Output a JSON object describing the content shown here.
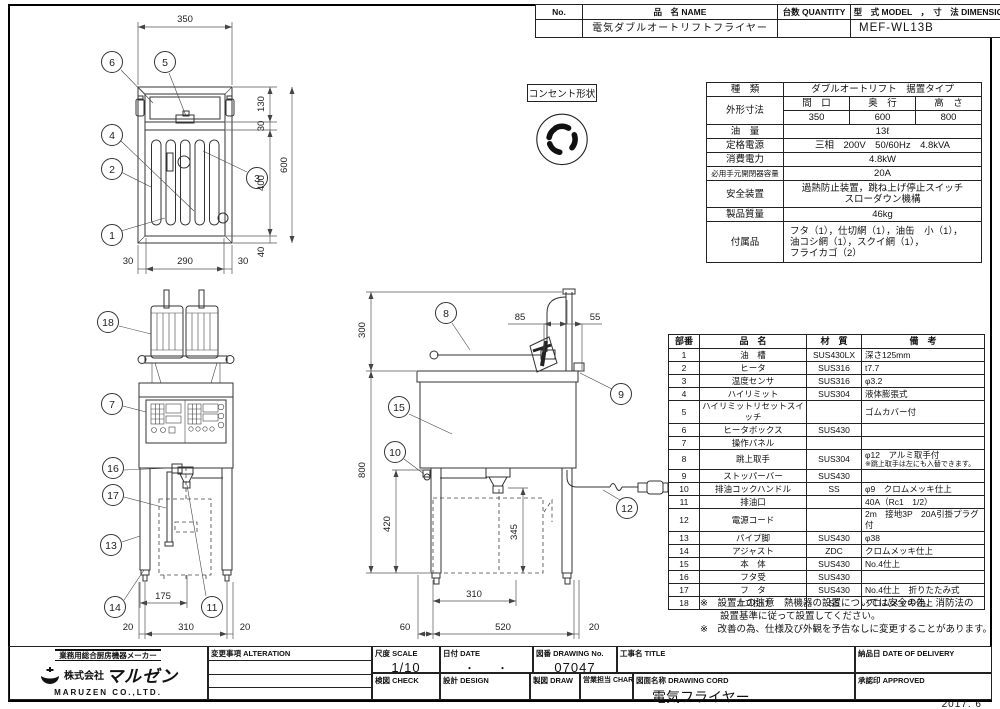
{
  "title_table": {
    "no_label": "No.",
    "name_label": "品　名 NAME",
    "qty_label": "台数 QUANTITY",
    "model_label": "型　式 MODEL　，　寸　法 DIMENSION",
    "name_value": "電気ダブルオートリフトフライヤー",
    "qty_value": "",
    "model_value": "MEF-WL13B"
  },
  "outlet_box": {
    "label": "コンセント形状"
  },
  "spec_table": {
    "kind_label": "種　類",
    "kind_value": "ダブルオートリフト　据置タイプ",
    "dims_label": "外形寸法",
    "width_label": "間　口",
    "depth_label": "奥　行",
    "height_label": "高　さ",
    "width_value": "350",
    "depth_value": "600",
    "height_value": "800",
    "oil_label": "油　量",
    "oil_value": "13ℓ",
    "power_label": "定格電源",
    "power_value": "三相　200V　50/60Hz　4.8kVA",
    "consumption_label": "消費電力",
    "consumption_value": "4.8kW",
    "breaker_label": "必用手元開閉器容量",
    "breaker_value": "20A",
    "safety_label": "安全装置",
    "safety_line1": "過熱防止装置，跳ね上げ停止スイッチ",
    "safety_line2": "スローダウン機構",
    "weight_label": "製品質量",
    "weight_value": "46kg",
    "accessories_label": "付属品",
    "accessories_line1": "フタ（1），仕切網（1），油缶　小（1），",
    "accessories_line2": "油コシ網（1），スクイ網（1），",
    "accessories_line3": "フライカゴ（2）"
  },
  "parts_table": {
    "no_header": "部番",
    "name_header": "品　名",
    "material_header": "材　質",
    "remarks_header": "備　考",
    "rows": [
      {
        "no": "1",
        "name": "油　槽",
        "material": "SUS430LX",
        "remarks": "深さ125mm",
        "remarks2": ""
      },
      {
        "no": "2",
        "name": "ヒータ",
        "material": "SUS316",
        "remarks": "t7.7",
        "remarks2": ""
      },
      {
        "no": "3",
        "name": "温度センサ",
        "material": "SUS316",
        "remarks": "φ3.2",
        "remarks2": ""
      },
      {
        "no": "4",
        "name": "ハイリミット",
        "material": "SUS304",
        "remarks": "液体膨張式",
        "remarks2": ""
      },
      {
        "no": "5",
        "name": "ハイリミットリセットスイッチ",
        "material": "",
        "remarks": "ゴムカバー付",
        "remarks2": ""
      },
      {
        "no": "6",
        "name": "ヒータボックス",
        "material": "SUS430",
        "remarks": "",
        "remarks2": ""
      },
      {
        "no": "7",
        "name": "操作パネル",
        "material": "",
        "remarks": "",
        "remarks2": ""
      },
      {
        "no": "8",
        "name": "跳上取手",
        "material": "SUS304",
        "remarks": "φ12　アルミ取手付",
        "remarks2": "※跳上取手は左にも入替できます。"
      },
      {
        "no": "9",
        "name": "ストッパーバー",
        "material": "SUS430",
        "remarks": "",
        "remarks2": ""
      },
      {
        "no": "10",
        "name": "排油コックハンドル",
        "material": "SS",
        "remarks": "φ9　クロムメッキ仕上",
        "remarks2": ""
      },
      {
        "no": "11",
        "name": "排油口",
        "material": "",
        "remarks": "40A（Rc1　1/2）",
        "remarks2": ""
      },
      {
        "no": "12",
        "name": "電源コード",
        "material": "",
        "remarks": "2m　接地3P　20A引掛プラグ付",
        "remarks2": ""
      },
      {
        "no": "13",
        "name": "パイプ脚",
        "material": "SUS430",
        "remarks": "φ38",
        "remarks2": ""
      },
      {
        "no": "14",
        "name": "アジャスト",
        "material": "ZDC",
        "remarks": "クロムメッキ仕上",
        "remarks2": ""
      },
      {
        "no": "15",
        "name": "本　体",
        "material": "SUS430",
        "remarks": "No.4仕上",
        "remarks2": ""
      },
      {
        "no": "16",
        "name": "フタ受",
        "material": "SUS430",
        "remarks": "",
        "remarks2": ""
      },
      {
        "no": "17",
        "name": "フ　タ",
        "material": "SUS430",
        "remarks": "No.4仕上　折りたたみ式",
        "remarks2": ""
      },
      {
        "no": "18",
        "name": "カゴ掛け",
        "material": "SS",
        "remarks": "クロムメッキ仕上",
        "remarks2": ""
      }
    ]
  },
  "notes": {
    "note1_line1": "※　設置上の注意　熱機器の設置については安全の為、消防法の",
    "note1_line2": "設置基準に従って設置してください。",
    "note2": "※　改善の為、仕様及び外観を予告なしに変更することがあります。"
  },
  "title_block": {
    "alteration_label": "変更事項 ALTERATION",
    "scale_label": "尺度 SCALE",
    "scale_value": "1/10",
    "date_label": "日付 DATE",
    "date_value": "・　　・",
    "drawing_no_label": "図番 DRAWING No.",
    "drawing_no_value": "07047",
    "title_label": "工事名 TITLE",
    "delivery_label": "納品日 DATE OF DELIVERY",
    "check_label": "検図 CHECK",
    "design_label": "設計 DESIGN",
    "draw_label": "製図 DRAW",
    "charge_label": "営業担当 CHARGE",
    "drawing_name_label": "図面名称 DRAWING CORD",
    "drawing_name_value": "電気フライヤー",
    "approved_label": "承認印 APPROVED"
  },
  "logo": {
    "tagline": "業務用総合厨房機器メーカー",
    "company_prefix": "株式会社",
    "company_name": "マルゼン",
    "company_en": "MARUZEN CO.,LTD."
  },
  "footer": {
    "date_note": "2017. 6"
  },
  "drawing": {
    "plan_view": {
      "callouts": [
        "6",
        "5",
        "4",
        "2",
        "1",
        "3"
      ],
      "dim_top": "350",
      "dim_130": "130",
      "dim_30_right": "30",
      "dim_400": "400",
      "dim_40": "40",
      "dim_600": "600",
      "dim_30_bl": "30",
      "dim_290": "290",
      "dim_30_br": "30"
    },
    "front_view": {
      "callouts": [
        "18",
        "7",
        "16",
        "17",
        "13",
        "14",
        "11"
      ],
      "dim_175": "175",
      "dim_20_left": "20",
      "dim_310": "310",
      "dim_20_right": "20"
    },
    "side_view": {
      "callouts": [
        "8",
        "9",
        "15",
        "10",
        "12"
      ],
      "dim_300": "300",
      "dim_85": "85",
      "dim_55": "55",
      "dim_800": "800",
      "dim_420": "420",
      "dim_345": "345",
      "dim_310": "310",
      "dim_60": "60",
      "dim_520": "520",
      "dim_20": "20"
    }
  }
}
